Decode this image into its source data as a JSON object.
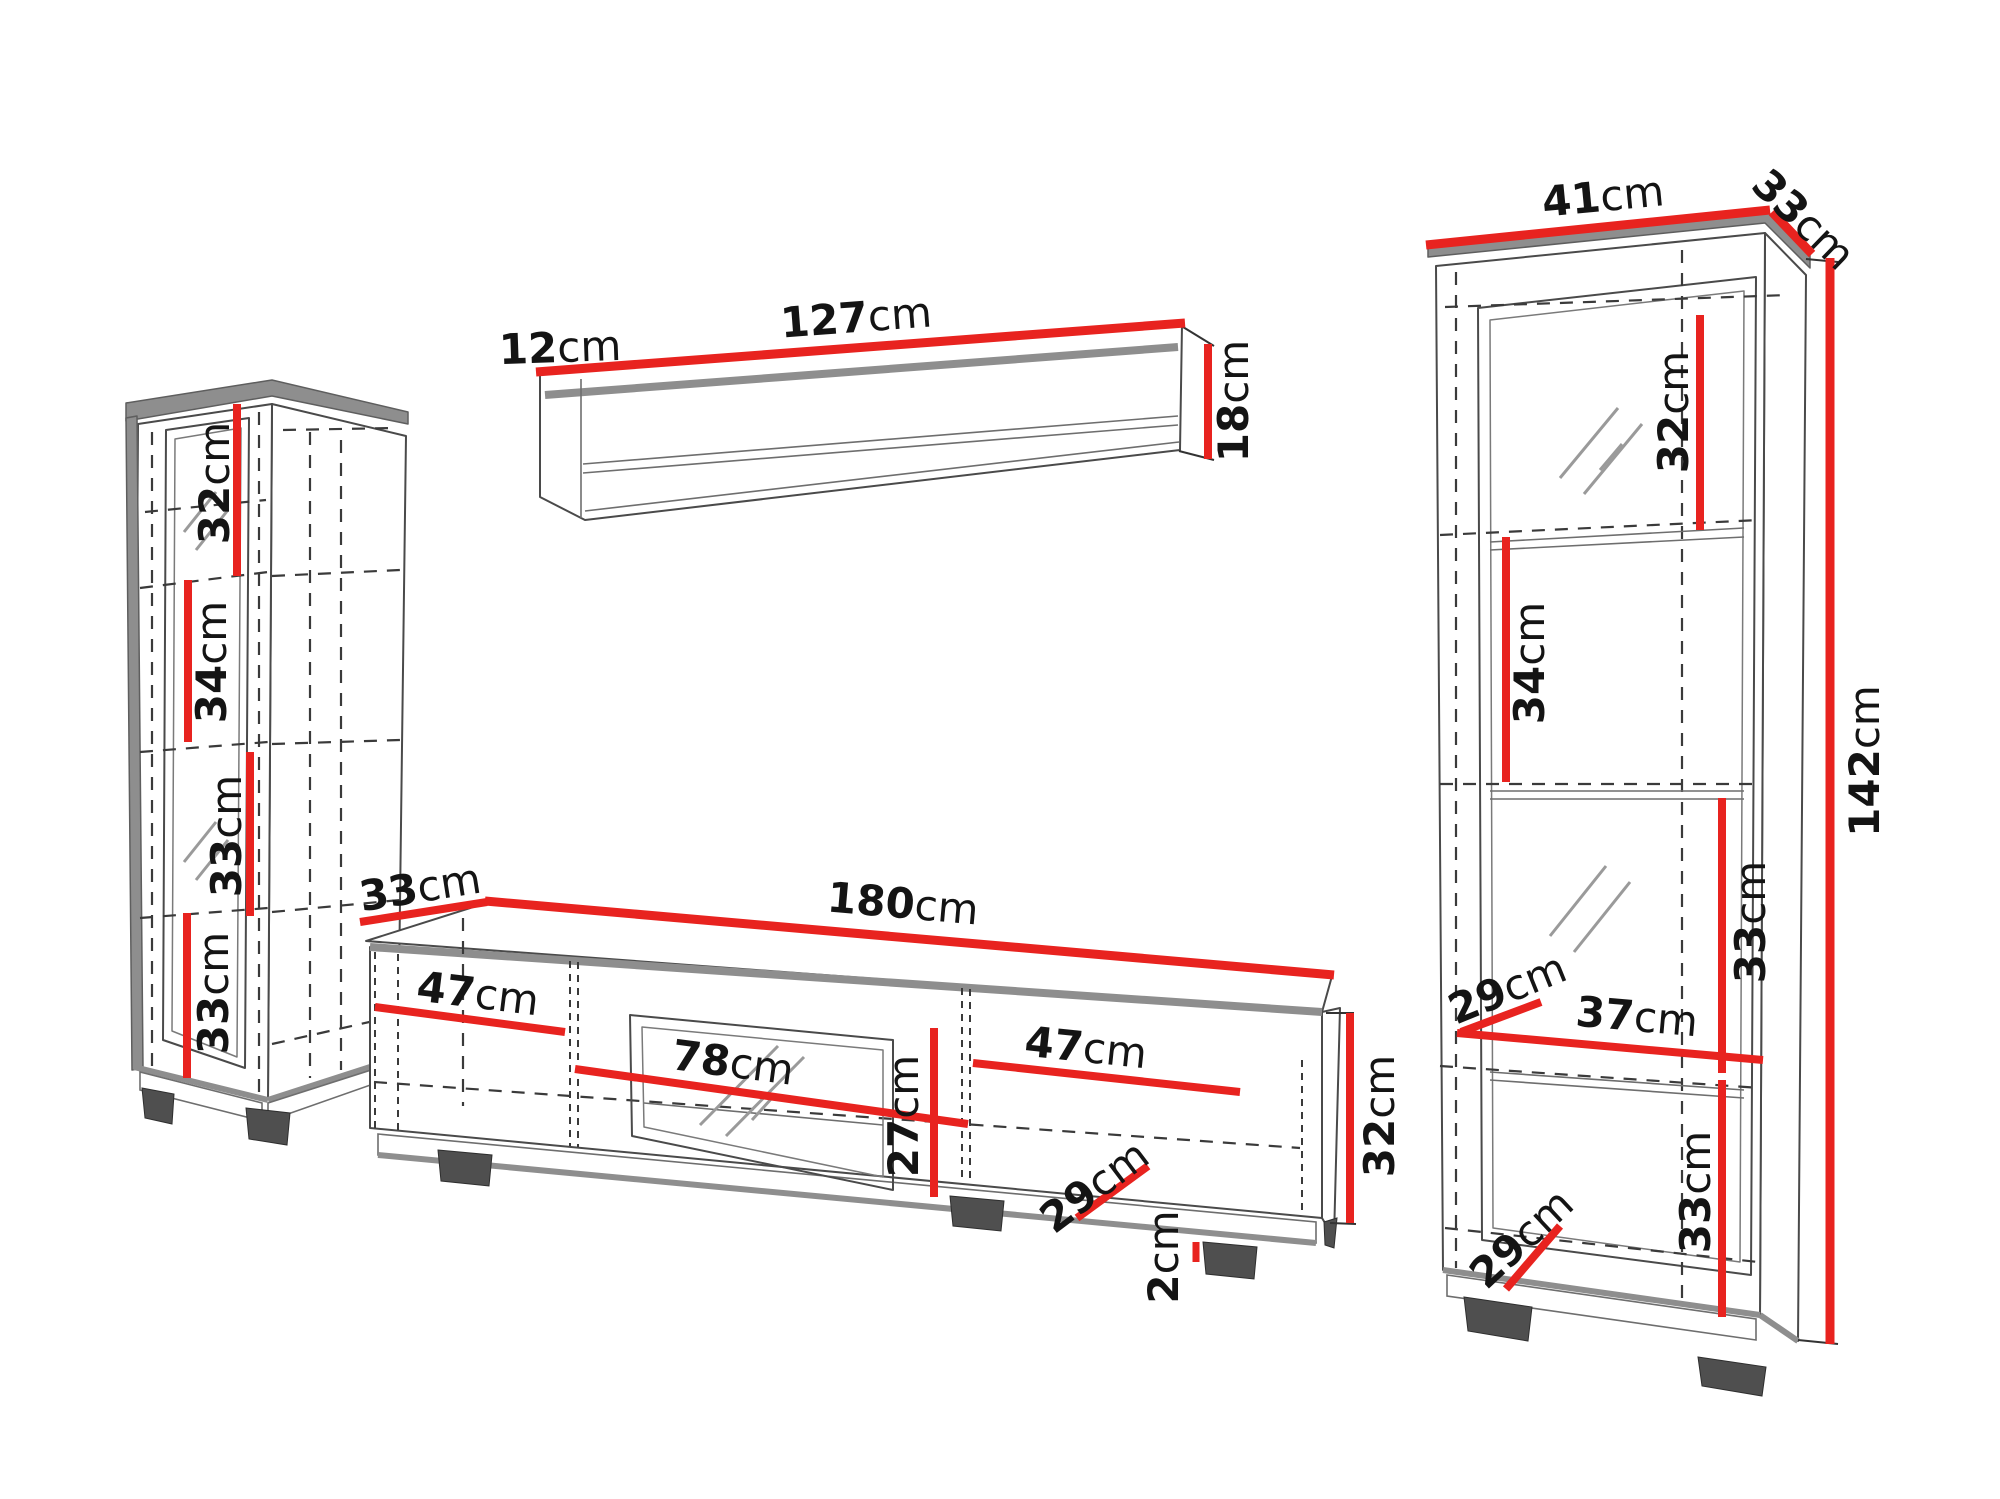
{
  "title": "Wall unit furniture dimensions diagram",
  "colors": {
    "red": "#e8231f",
    "slab": "#8e8e8e",
    "line": "#4a4a4a",
    "dash": "#3a3a3a",
    "foot": "#4f4f4f",
    "shine": "#9a9a9a",
    "text": "#141414"
  },
  "left_cabinet": {
    "d1": {
      "num": "32",
      "unit": "cm"
    },
    "d2": {
      "num": "34",
      "unit": "cm"
    },
    "d3": {
      "num": "33",
      "unit": "cm"
    },
    "d4": {
      "num": "33",
      "unit": "cm"
    }
  },
  "wall_shelf": {
    "depth": {
      "num": "12",
      "unit": "cm"
    },
    "width": {
      "num": "127",
      "unit": "cm"
    },
    "height": {
      "num": "18",
      "unit": "cm"
    }
  },
  "tv_stand": {
    "depth": {
      "num": "33",
      "unit": "cm"
    },
    "width": {
      "num": "180",
      "unit": "cm"
    },
    "left_section": {
      "num": "47",
      "unit": "cm"
    },
    "glass_width": {
      "num": "78",
      "unit": "cm"
    },
    "glass_height": {
      "num": "27",
      "unit": "cm"
    },
    "right_section": {
      "num": "47",
      "unit": "cm"
    },
    "inner_depth": {
      "num": "29",
      "unit": "cm"
    },
    "plinth": {
      "num": "2",
      "unit": "cm"
    },
    "height": {
      "num": "32",
      "unit": "cm"
    }
  },
  "right_cabinet": {
    "top_width": {
      "num": "41",
      "unit": "cm"
    },
    "top_depth": {
      "num": "33",
      "unit": "cm"
    },
    "s1": {
      "num": "32",
      "unit": "cm"
    },
    "s2": {
      "num": "34",
      "unit": "cm"
    },
    "height": {
      "num": "142",
      "unit": "cm"
    },
    "s3": {
      "num": "33",
      "unit": "cm"
    },
    "inner_depth_top": {
      "num": "29",
      "unit": "cm"
    },
    "inner_width": {
      "num": "37",
      "unit": "cm"
    },
    "s4": {
      "num": "33",
      "unit": "cm"
    },
    "inner_depth_bottom": {
      "num": "29",
      "unit": "cm"
    }
  }
}
